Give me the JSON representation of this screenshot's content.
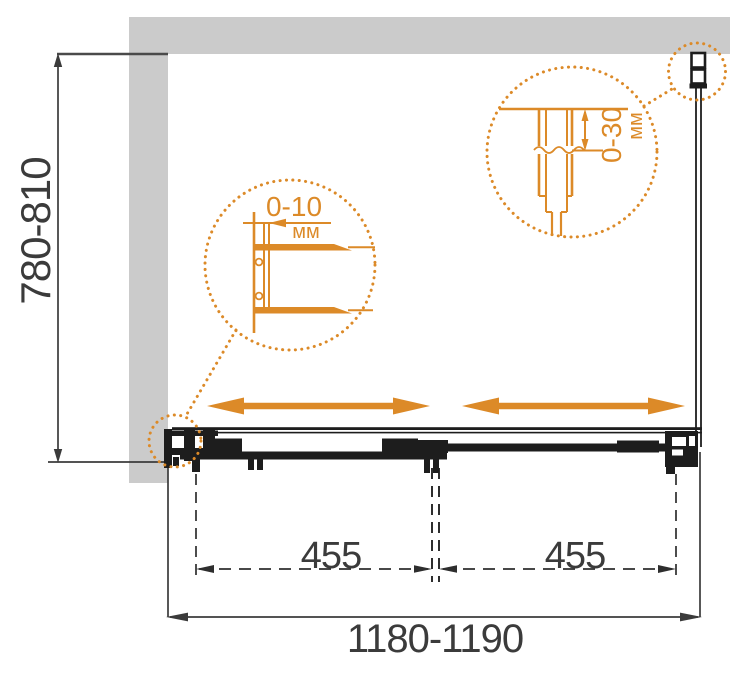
{
  "diagram": {
    "subject": "Sliding shower screen installation dimensions (top view)",
    "units": "мм",
    "colors": {
      "accent": "#DC8A28",
      "wall": "#CBCBCB",
      "dimension_line": "#3B3B3B",
      "drawing": "#1D1D1D"
    },
    "dimensions": {
      "height_range": "780-810",
      "width_range": "1180-1190",
      "door_left_travel": "455",
      "door_right_travel": "455"
    },
    "callouts": {
      "wall_profile": {
        "value": "0-10",
        "unit": "мм"
      },
      "top_bracket": {
        "value": "0-30",
        "unit": "мм"
      }
    }
  }
}
